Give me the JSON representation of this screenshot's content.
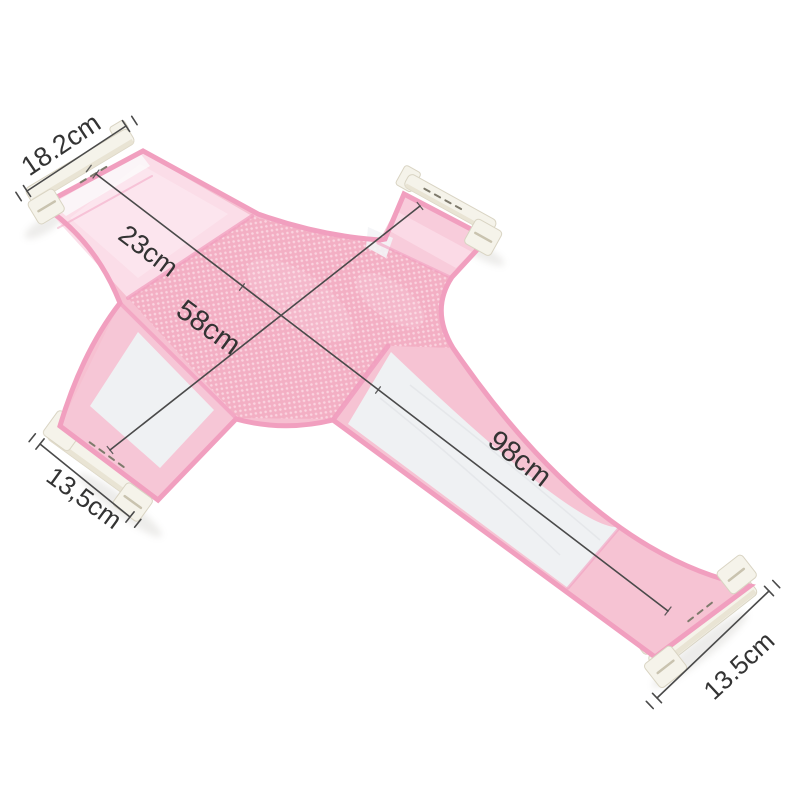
{
  "dimensions": {
    "top_width": "18.2cm",
    "upper_section": "23cm",
    "mid_section": "58cm",
    "tail_section": "98cm",
    "left_width": "13,5cm",
    "bottom_width": "13.5cm"
  },
  "colors": {
    "background": "#ffffff",
    "fabric_pink": "#f6c0d1",
    "mesh_pink": "#f3afc4",
    "mesh_dot": "#fad3df",
    "binding_pink": "#f19fbf",
    "panel_light_pink": "#fbdde8",
    "panel_white": "#eff1f3",
    "plastic_white": "#f5f3ea",
    "dimension_line": "#4a4a4a",
    "label_color": "#333333"
  }
}
